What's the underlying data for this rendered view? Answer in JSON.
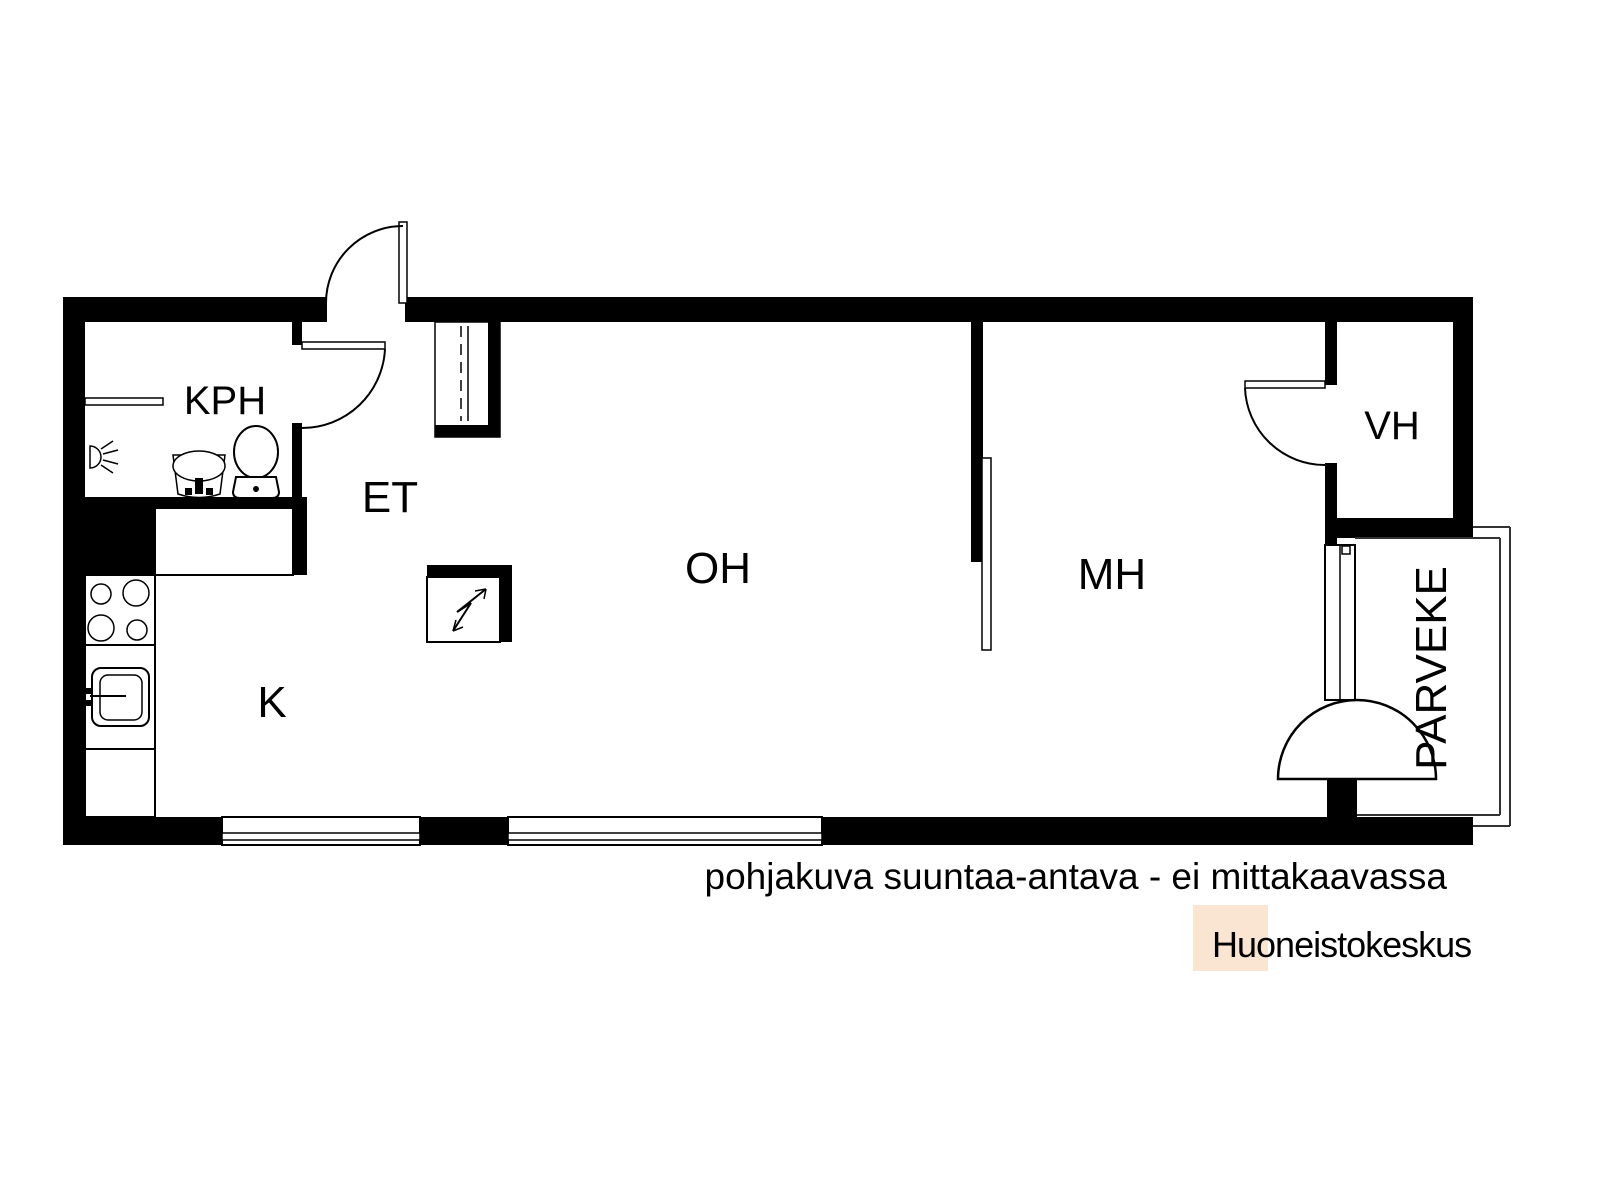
{
  "floorplan": {
    "labels": {
      "bathroom": "KPH",
      "entry": "ET",
      "living_room": "OH",
      "kitchen": "K",
      "bedroom": "MH",
      "closet": "VH",
      "balcony": "PARVEKE"
    },
    "disclaimer": "pohjakuva suuntaa-antava - ei mittakaavassa",
    "colors": {
      "walls": "#000000",
      "disclaimer_text": "#a8a8a8",
      "logo_text": "#ef7622",
      "logo_square": "#fae5d3",
      "background": "#ffffff"
    },
    "icons": [
      "shower-icon",
      "washbasin-icon",
      "toilet-icon",
      "stove-icon",
      "kitchen-sink-icon",
      "electrical-panel-icon",
      "wardrobe-icon",
      "door-swing-icon",
      "sliding-door-icon",
      "window-icon",
      "balcony-railing"
    ]
  },
  "branding": {
    "agency": "Huoneistokeskus"
  }
}
